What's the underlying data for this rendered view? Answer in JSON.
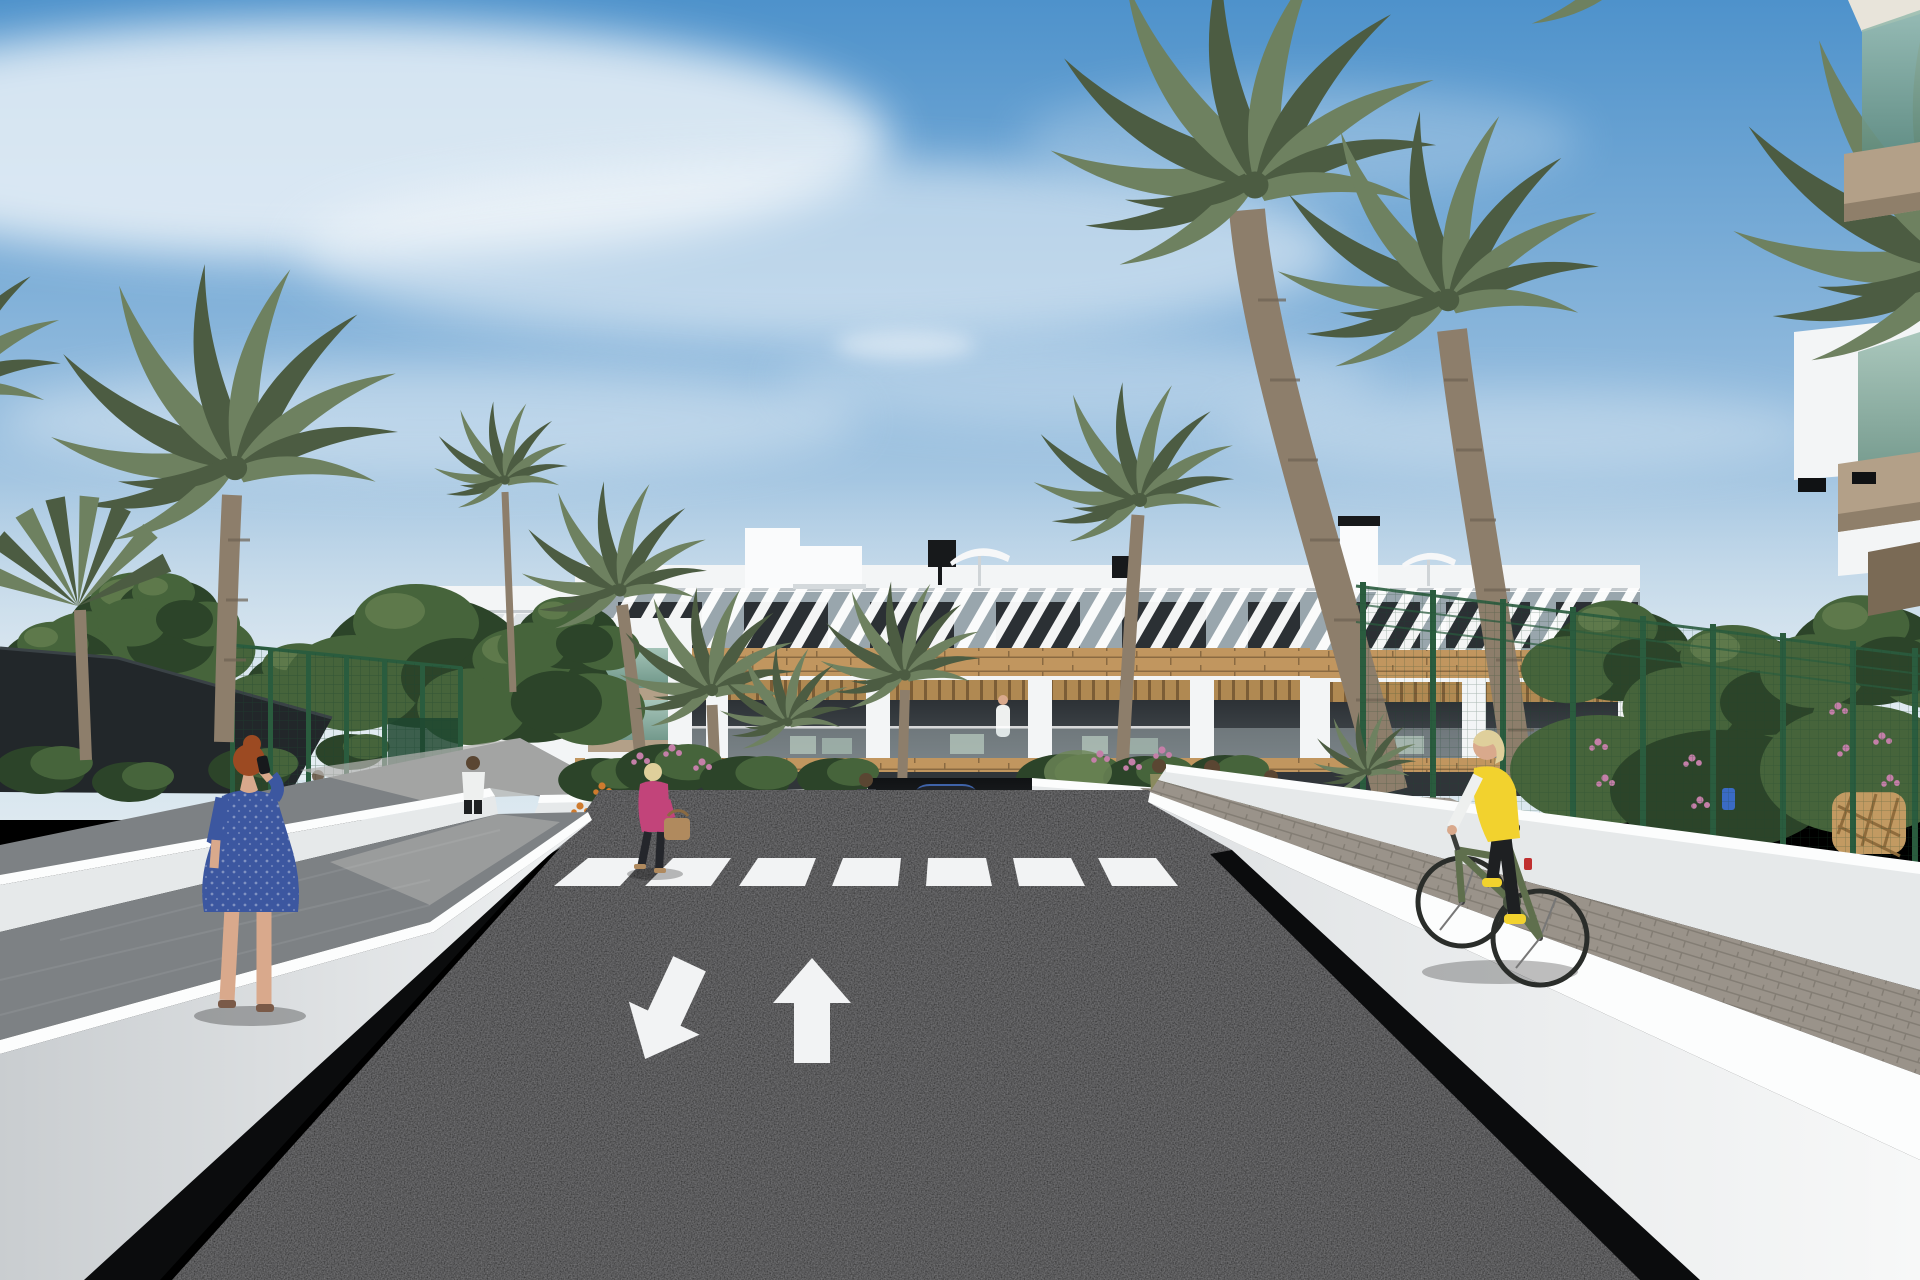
{
  "meta": {
    "domain": "Natural-Image",
    "title": "Residential complex street view - 3D architectural render",
    "description": "Computer-generated exterior visualization: white Mediterranean apartment block with slatted roof pergolas, wood cladding bands and recessed balconies; dark asphalt access road with zebra crosswalk and lane arrows; blue SUV at underground parking ramp; pedestrians, cyclist and palm trees under a blue sky with wispy clouds.",
    "time_of_day": "daytime",
    "weather": "sunny, wispy cirrus clouds"
  },
  "colors": {
    "sky_top": "#4e92cb",
    "sky_mid": "#8ab6db",
    "sky_horizon": "#dde9f0",
    "cloud_white": "#f4f8fb",
    "building_white": "#f3f5f6",
    "building_shade": "#b7c3ca",
    "parapet_shadow": "#99a6ad",
    "wood_cladding": "#c1965f",
    "wood_dark": "#8a6a42",
    "window_glass": "#2b3034",
    "balcony_interior": "#363b3f",
    "balustrade_glass": "#c9d6d8",
    "glass_green": "#7da294",
    "slab_tan": "#b3a088",
    "roof_white": "#fafbfc",
    "chimney_black": "#17191b",
    "umbrella_white": "#f6f7f8",
    "road_asphalt": "#1b1c1e",
    "road_marking_white": "#f2f3f4",
    "wall_face_white": "#e6e9ea",
    "wall_cap_white": "#fcfdfd",
    "wall_shadow_black": "#0b0c0d",
    "path_gray": "#7d8184",
    "path_gray_lit": "#b3b3b0",
    "paver_brick": "#9a938a",
    "fence_green": "#2a5c3e",
    "sail_dark": "#22272a",
    "foliage_dark": "#2c4429",
    "foliage_mid": "#46643b",
    "foliage_light": "#6e8757",
    "palm_green": "#6e8160",
    "palm_dark": "#4c5c42",
    "palm_trunk": "#8d7e6b",
    "flower_pink": "#c47fa8",
    "flower_orange": "#cf7b2e",
    "car_blue": "#3f63a8",
    "car_glass": "#20242a",
    "skin": "#d9a98c",
    "hair_auburn": "#9c4a22",
    "hair_blonde": "#dfcf9b",
    "hair_brown": "#5a4632",
    "dress_blue": "#3c57a0",
    "jacket_pink": "#c2447a",
    "bag_tan": "#b08a5e",
    "vest_yellow": "#f2d22e",
    "leggings_black": "#1e2022",
    "bike_olive": "#5f6f4d",
    "shirt_white": "#eef0ef",
    "rattan_tan": "#c29a62"
  },
  "scene": {
    "sky": {
      "clouds": "diagonal cirrus band upper-left, fainter streaks centre and right"
    },
    "buildings": {
      "main_block": "3-storey white apartment building, slatted pergola parapet, wood cladding band, recessed balconies with glass rails",
      "left_wing": "low white building behind trees",
      "glass_balcony_block": "white gable end with two green-glass balconies",
      "right_block": "matching apartment wing behind tall palms",
      "foreground_right": "near building edge with green glass balconies, tan slabs and black wall lamps"
    },
    "roof_items": [
      "white stair box",
      "black chimney",
      "white parasol",
      "roof box",
      "white parasol",
      "black vent"
    ],
    "road": {
      "surface": "dark asphalt two-way access road",
      "crosswalk_stripes": 7,
      "lane_arrows": [
        "down-left exit arrow",
        "straight-ahead arrow"
      ],
      "ramp": "underground parking ramp with small painted entry/exit arrows"
    },
    "vehicles": [
      {
        "name": "blue-suv",
        "description": "dark blue SUV facing camera at parking ramp"
      }
    ],
    "figures": [
      {
        "name": "woman-on-phone",
        "description": "red-haired woman in blue patterned dress, seen from behind, phone to ear, left walkway"
      },
      {
        "name": "man-white-shirt",
        "description": "man in white t-shirt walking by green fence gate"
      },
      {
        "name": "woman-pink-jacket",
        "description": "blonde woman in pink jacket with tan handbag walking left"
      },
      {
        "name": "woman-dark-top",
        "description": "pedestrian standing near right end of crosswalk"
      },
      {
        "name": "mother-and-child",
        "description": "woman with small child near bike racks"
      },
      {
        "name": "woman-at-bike-rack",
        "description": "woman standing at black hoop bike racks"
      },
      {
        "name": "person-behind-fence",
        "description": "faint figure in light blue inside fenced court"
      },
      {
        "name": "balcony-resident",
        "description": "tiny figure in white on first-floor balcony"
      },
      {
        "name": "cyclist",
        "description": "blonde woman, yellow vest, white sleeves, black leggings, olive bicycle on brick path"
      }
    ],
    "vegetation": {
      "palm_trees": 12,
      "deciduous_trees": 8,
      "flower_colors": [
        "pink",
        "orange"
      ],
      "hedges": "dense shrubs behind right fence"
    },
    "site_elements": [
      "black shade sail over sports court",
      "green mesh fences",
      "white retaining walls",
      "gray paved walkways",
      "brick paved cycle path",
      "bike racks",
      "rattan chair",
      "white planters"
    ]
  }
}
